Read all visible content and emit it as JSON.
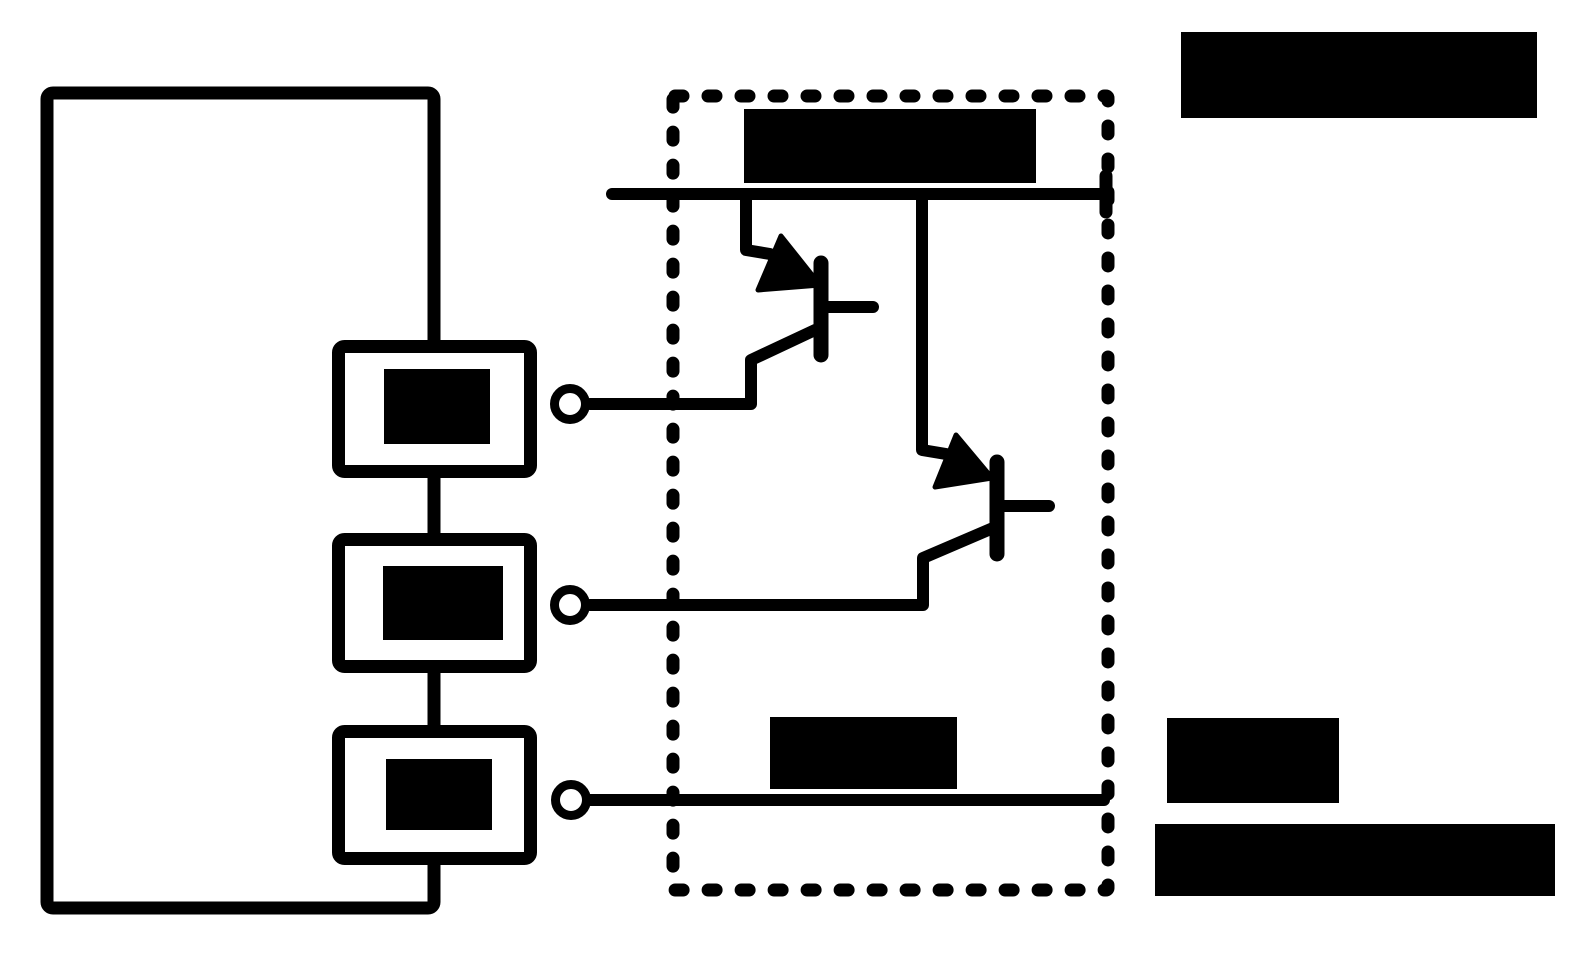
{
  "canvas": {
    "width": 1582,
    "height": 958,
    "background": "#ffffff",
    "ink": "#000000"
  },
  "figure": {
    "kind": "circuit-diagram",
    "description": "Controller block with three pin modules wired through open-circle terminals to a dashed driver module containing two cascaded transistors on a top supply bus; all text labels are redacted black bars",
    "visible_text": [],
    "redacted_label_count": 8
  },
  "shapes": [
    {
      "name": "controller-outline-box",
      "type": "rect",
      "x": 47,
      "y": 93,
      "w": 387,
      "h": 815,
      "sw": 13,
      "rx": 6,
      "fill": "none"
    },
    {
      "name": "pin-module-1-box",
      "type": "rect",
      "x": 338.5,
      "y": 346.5,
      "w": 192,
      "h": 125,
      "sw": 13,
      "rx": 6,
      "fill": "#ffffff"
    },
    {
      "name": "pin-module-1-redacted-label",
      "type": "rect",
      "x": 384,
      "y": 369,
      "w": 106,
      "h": 75,
      "fill": "#000000"
    },
    {
      "name": "pin-module-2-box",
      "type": "rect",
      "x": 338.5,
      "y": 539.5,
      "w": 192,
      "h": 127,
      "sw": 13,
      "rx": 6,
      "fill": "#ffffff"
    },
    {
      "name": "pin-module-2-redacted-label",
      "type": "rect",
      "x": 383,
      "y": 566,
      "w": 120,
      "h": 74,
      "fill": "#000000"
    },
    {
      "name": "pin-module-3-box",
      "type": "rect",
      "x": 338.5,
      "y": 731.5,
      "w": 192,
      "h": 127,
      "sw": 13,
      "rx": 6,
      "fill": "#ffffff"
    },
    {
      "name": "pin-module-3-redacted-label",
      "type": "rect",
      "x": 386,
      "y": 759,
      "w": 106,
      "h": 71,
      "fill": "#000000"
    },
    {
      "name": "driver-module-dashed-boundary",
      "type": "rect",
      "x": 673,
      "y": 96,
      "w": 435,
      "h": 794,
      "sw": 13,
      "rx": 2,
      "fill": "none",
      "dash": "8 25"
    },
    {
      "name": "supply-bus-line",
      "type": "line",
      "x1": 612,
      "y1": 194,
      "x2": 1104,
      "y2": 194,
      "sw": 12
    },
    {
      "name": "supply-bus-end-tick",
      "type": "line",
      "x1": 1106,
      "y1": 176,
      "x2": 1106,
      "y2": 212,
      "sw": 13
    },
    {
      "name": "transistor1-collector-lead",
      "type": "polyline",
      "pts": [
        [
          746,
          194
        ],
        [
          746,
          250
        ],
        [
          770,
          254
        ],
        [
          788,
          266
        ]
      ],
      "sw": 12
    },
    {
      "name": "transistor1-collector-arrowhead",
      "type": "polygon",
      "pts": [
        [
          820,
          285
        ],
        [
          781,
          236
        ],
        [
          758,
          290
        ]
      ],
      "fill": "#000000",
      "sw": 5
    },
    {
      "name": "transistor1-base-bar",
      "type": "line",
      "x1": 821,
      "y1": 263,
      "x2": 821,
      "y2": 355,
      "sw": 15
    },
    {
      "name": "transistor1-base-lead",
      "type": "line",
      "x1": 821,
      "y1": 307,
      "x2": 873,
      "y2": 307,
      "sw": 12
    },
    {
      "name": "transistor1-emitter-lead",
      "type": "polyline",
      "pts": [
        [
          815,
          330
        ],
        [
          751,
          360
        ],
        [
          751,
          404
        ],
        [
          590,
          404
        ]
      ],
      "sw": 12
    },
    {
      "name": "transistor2-collector-lead",
      "type": "polyline",
      "pts": [
        [
          922,
          194
        ],
        [
          922,
          450
        ],
        [
          946,
          454
        ],
        [
          962,
          464
        ]
      ],
      "sw": 12
    },
    {
      "name": "transistor2-collector-arrowhead",
      "type": "polygon",
      "pts": [
        [
          992,
          478
        ],
        [
          956,
          435
        ],
        [
          935,
          487
        ]
      ],
      "fill": "#000000",
      "sw": 5
    },
    {
      "name": "transistor2-base-bar",
      "type": "line",
      "x1": 997,
      "y1": 462,
      "x2": 997,
      "y2": 554,
      "sw": 15
    },
    {
      "name": "transistor2-base-lead",
      "type": "line",
      "x1": 997,
      "y1": 506,
      "x2": 1049,
      "y2": 506,
      "sw": 12
    },
    {
      "name": "transistor2-emitter-lead",
      "type": "polyline",
      "pts": [
        [
          993,
          528
        ],
        [
          923,
          558
        ],
        [
          923,
          605
        ],
        [
          590,
          605
        ]
      ],
      "sw": 12
    },
    {
      "name": "output-bottom-line",
      "type": "line",
      "x1": 590,
      "y1": 800,
      "x2": 1104,
      "y2": 800,
      "sw": 12
    },
    {
      "name": "terminal-1-circle",
      "type": "circle",
      "cx": 570,
      "cy": 404,
      "r": 15.5,
      "sw": 9,
      "fill": "#ffffff"
    },
    {
      "name": "terminal-2-circle",
      "type": "circle",
      "cx": 570,
      "cy": 605,
      "r": 15.5,
      "sw": 9,
      "fill": "#ffffff"
    },
    {
      "name": "terminal-3-circle",
      "type": "circle",
      "cx": 571,
      "cy": 800,
      "r": 15.5,
      "sw": 9,
      "fill": "#ffffff"
    },
    {
      "name": "redacted-label-driver-top",
      "type": "rect",
      "x": 744,
      "y": 109,
      "w": 292,
      "h": 74,
      "fill": "#000000"
    },
    {
      "name": "redacted-label-driver-bottom",
      "type": "rect",
      "x": 770,
      "y": 717,
      "w": 187,
      "h": 72,
      "fill": "#000000"
    },
    {
      "name": "redacted-title-top-right",
      "type": "rect",
      "x": 1181,
      "y": 32,
      "w": 356,
      "h": 86,
      "fill": "#000000"
    },
    {
      "name": "redacted-caption-line1",
      "type": "rect",
      "x": 1167,
      "y": 718,
      "w": 172,
      "h": 85,
      "fill": "#000000"
    },
    {
      "name": "redacted-caption-line2",
      "type": "rect",
      "x": 1155,
      "y": 824,
      "w": 400,
      "h": 72,
      "fill": "#000000"
    }
  ]
}
